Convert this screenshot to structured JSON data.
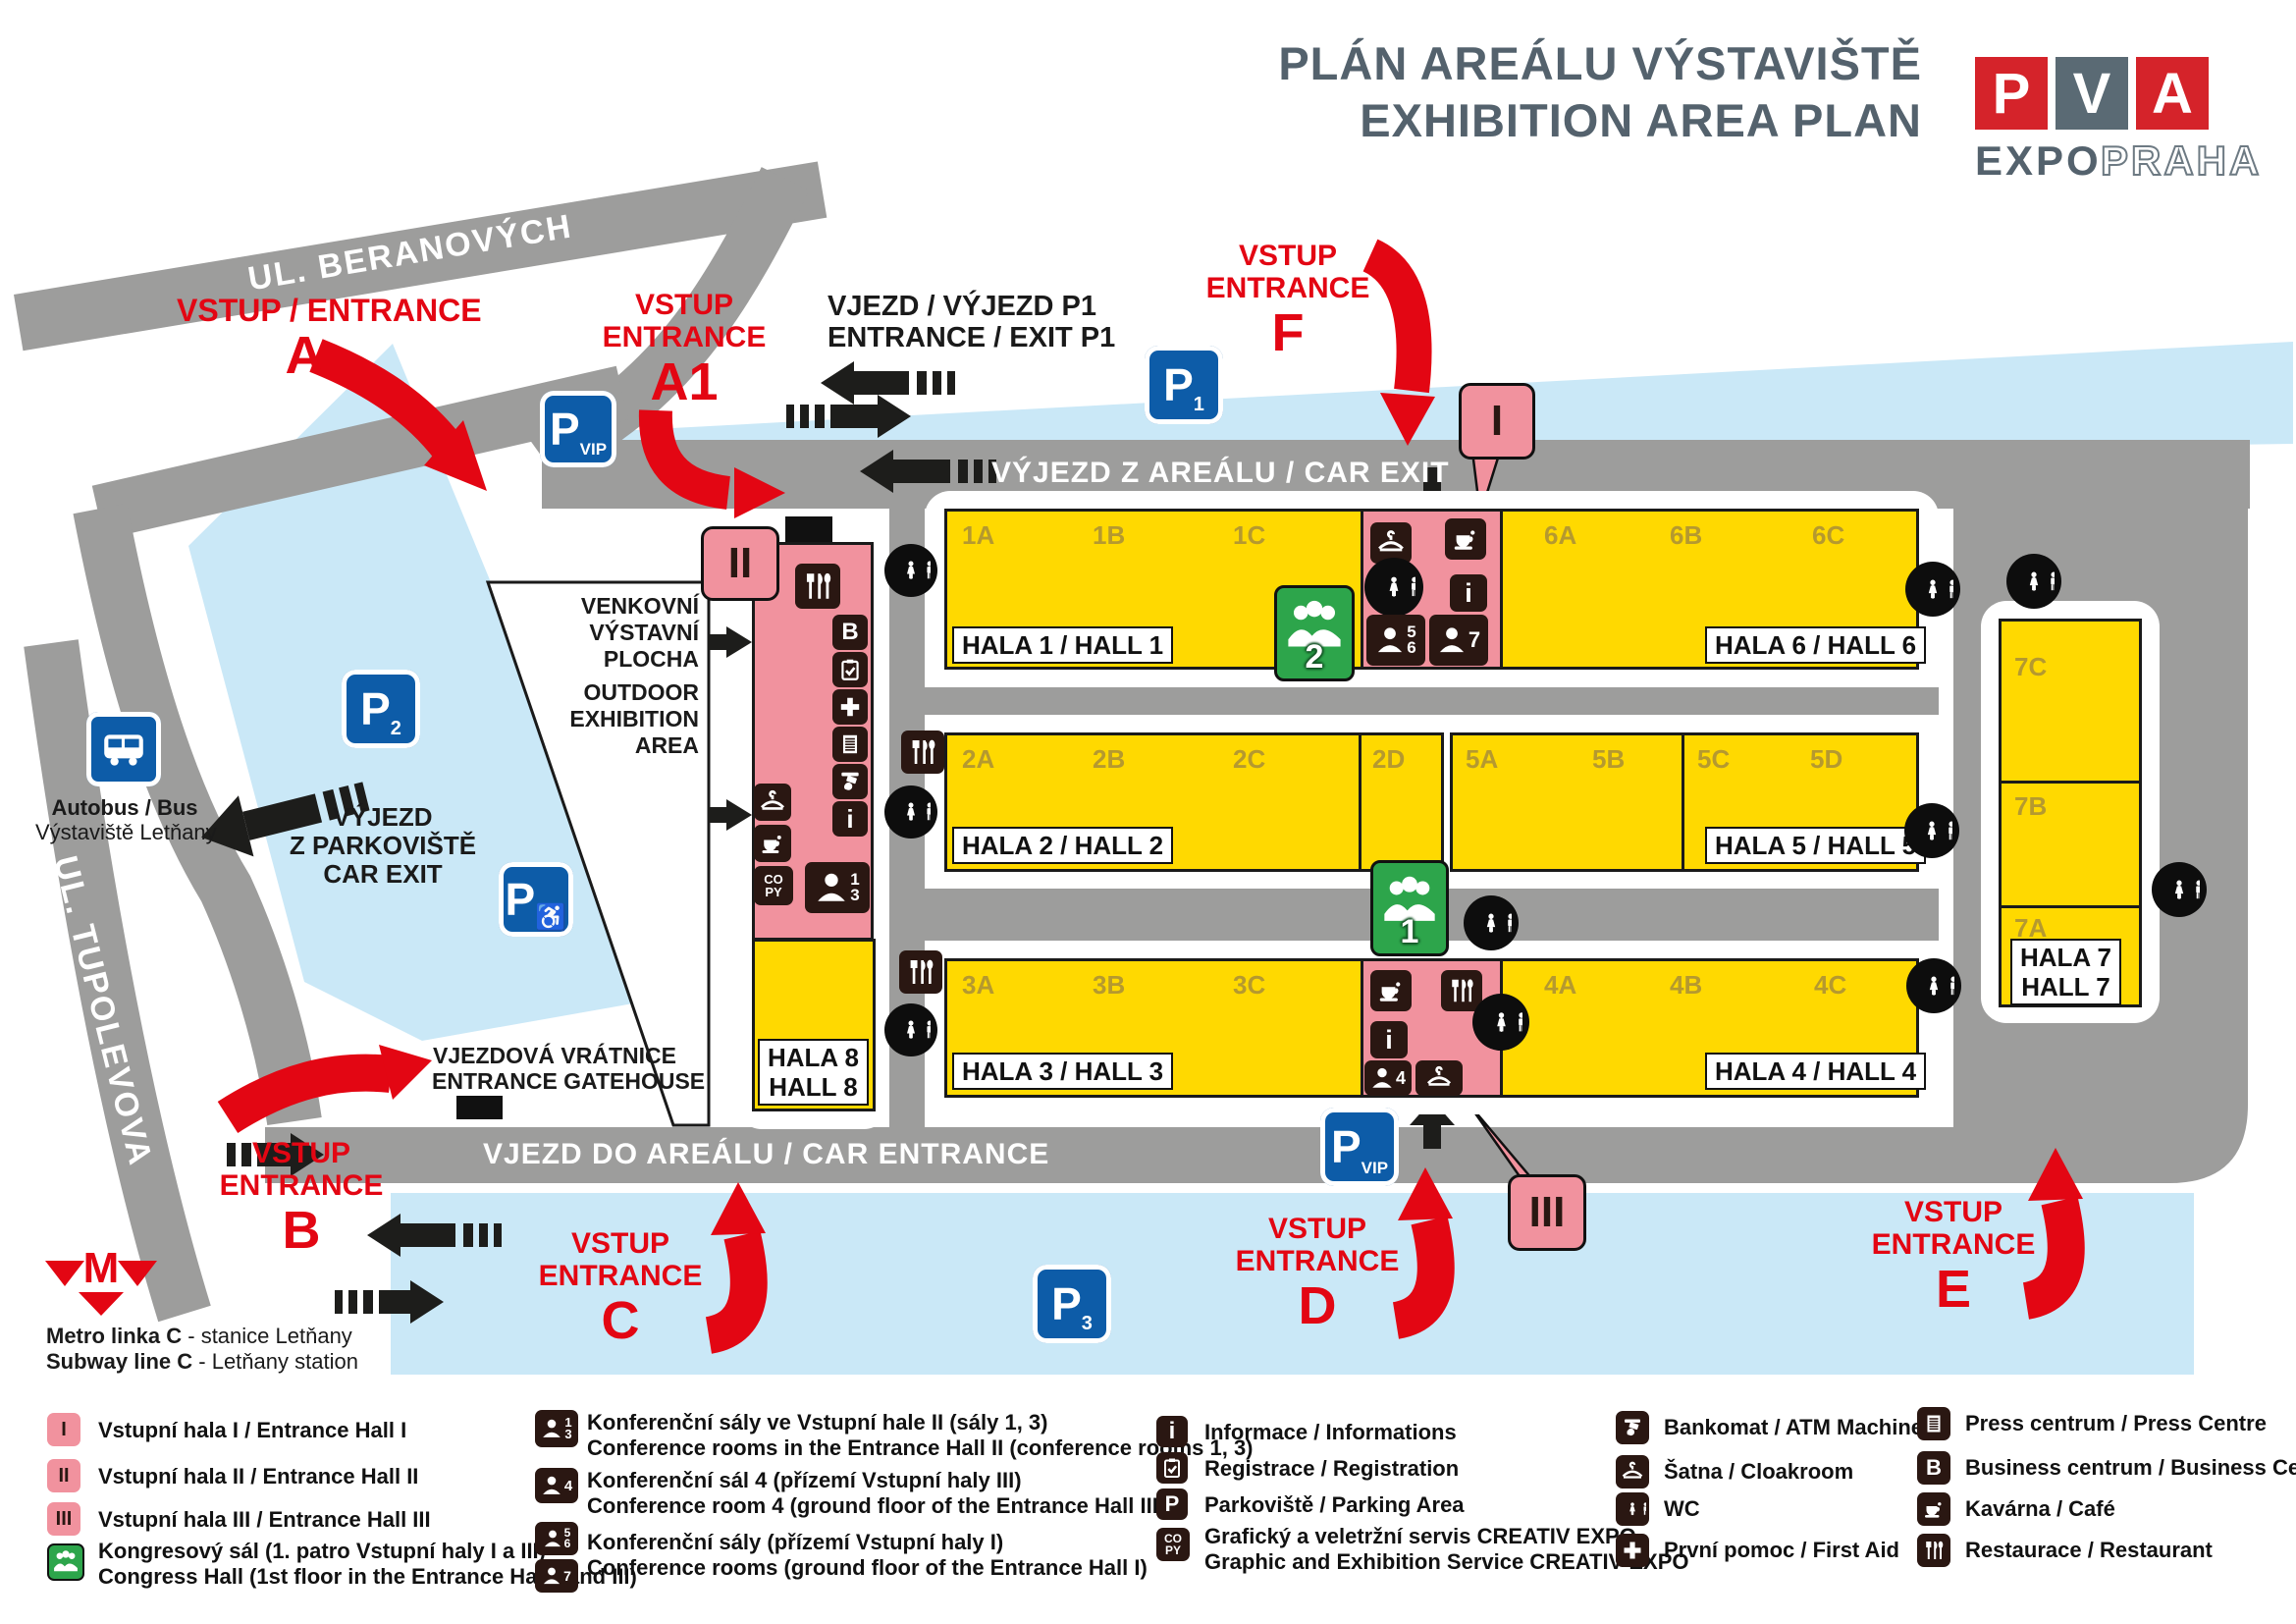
{
  "colors": {
    "red": "#e30613",
    "yellow": "#ffd900",
    "pink": "#f1929e",
    "road_gray": "#9d9d9c",
    "parking_blue": "#cae8f7",
    "sign_blue": "#0d5ca8",
    "icon_dark": "#2a1712",
    "green": "#2da54b",
    "title_gray": "#54626d",
    "section_gold": "#b5992f"
  },
  "title": {
    "line1": "PLÁN AREÁLU VÝSTAVIŠTĚ",
    "line2": "EXHIBITION AREA PLAN"
  },
  "logo": {
    "letters": [
      "P",
      "V",
      "A"
    ],
    "expo": "EXPO",
    "praha": "PRAHA"
  },
  "streets": {
    "beranovych": "UL. BERANOVÝCH",
    "tupolevova": "UL. TUPOLEVOVA"
  },
  "roads": {
    "car_exit_top": "VÝJEZD Z AREÁLU / CAR EXIT",
    "car_entrance": "VJEZD DO AREÁLU / CAR ENTRANCE",
    "gate_p1_line1": "VJEZD / VÝJEZD P1",
    "gate_p1_line2": "ENTRANCE / EXIT P1"
  },
  "parking_exit": {
    "line1": "VÝJEZD",
    "line2": "Z PARKOVIŠTĚ",
    "line3": "CAR EXIT"
  },
  "gatehouse": {
    "line1": "VJEZDOVÁ VRÁTNICE",
    "line2": "ENTRANCE GATEHOUSE"
  },
  "outdoor": {
    "cz0": "VENKOVNÍ",
    "cz1": "VÝSTAVNÍ",
    "cz2": "PLOCHA",
    "en0": "OUTDOOR",
    "en1": "EXHIBITION",
    "en2": "AREA"
  },
  "bus": {
    "line1": "Autobus / Bus",
    "line2": "Výstaviště Letňany"
  },
  "metro": {
    "m": "M",
    "line1_bold": "Metro linka C",
    "line1_rest": " - stanice Letňany",
    "line2_bold": "Subway line C",
    "line2_rest": " - Letňany station"
  },
  "entrances": {
    "a": {
      "label": "VSTUP / ENTRANCE",
      "letter": "A"
    },
    "a1": {
      "line1": "VSTUP",
      "line2": "ENTRANCE",
      "letter": "A1"
    },
    "b": {
      "line1": "VSTUP",
      "line2": "ENTRANCE",
      "letter": "B"
    },
    "c": {
      "line1": "VSTUP",
      "line2": "ENTRANCE",
      "letter": "C"
    },
    "d": {
      "line1": "VSTUP",
      "line2": "ENTRANCE",
      "letter": "D"
    },
    "e": {
      "line1": "VSTUP",
      "line2": "ENTRANCE",
      "letter": "E"
    },
    "f": {
      "line1": "VSTUP",
      "line2": "ENTRANCE",
      "letter": "F"
    }
  },
  "signs": {
    "p1": {
      "p": "P",
      "sub": "1"
    },
    "p2": {
      "p": "P",
      "sub": "2"
    },
    "p3": {
      "p": "P",
      "sub": "3"
    },
    "pvip_top": {
      "p": "P",
      "sub": "VIP"
    },
    "pvip_bottom": {
      "p": "P",
      "sub": "VIP"
    },
    "p_disabled": {
      "p": "P",
      "wheelchair": "♿"
    }
  },
  "halls": {
    "h1": {
      "name": "HALA 1 / HALL 1",
      "sections": [
        "1A",
        "1B",
        "1C"
      ]
    },
    "h2": {
      "name": "HALA 2 / HALL 2",
      "sections": [
        "2A",
        "2B",
        "2C",
        "2D"
      ]
    },
    "h3": {
      "name": "HALA 3 / HALL 3",
      "sections": [
        "3A",
        "3B",
        "3C"
      ]
    },
    "h4": {
      "name": "HALA 4 / HALL 4",
      "sections": [
        "4A",
        "4B",
        "4C"
      ]
    },
    "h5": {
      "name": "HALA 5 / HALL 5",
      "sections": [
        "5A",
        "5B",
        "5C",
        "5D"
      ]
    },
    "h6": {
      "name": "HALA 6 / HALL 6",
      "sections": [
        "6A",
        "6B",
        "6C"
      ]
    },
    "h7": {
      "name1": "HALA 7",
      "name2": "HALL 7",
      "sections": [
        "7C",
        "7B",
        "7A"
      ]
    },
    "h8": {
      "name1": "HALA 8",
      "name2": "HALL 8"
    }
  },
  "callouts": {
    "hall1": "I",
    "hall2": "II",
    "hall3": "III"
  },
  "congress_markers": {
    "hall1_marker": "2",
    "hall3_marker": "1"
  },
  "conference_markers": {
    "r13a": "1",
    "r13b": "3",
    "r4": "4",
    "r56a": "5",
    "r56b": "6",
    "r7": "7"
  },
  "icon_text": {
    "info": "i",
    "business": "B",
    "copy1": "CO",
    "copy2": "PY",
    "parking": "P",
    "wc": "WC"
  },
  "legend": {
    "entrance_halls": [
      {
        "symbol": "I",
        "text": "Vstupní hala I / Entrance Hall I"
      },
      {
        "symbol": "II",
        "text": "Vstupní hala II / Entrance Hall II"
      },
      {
        "symbol": "III",
        "text": "Vstupní hala III / Entrance Hall III"
      }
    ],
    "congress": {
      "line1": "Kongresový sál (1. patro Vstupní haly I a III)",
      "line2": "Congress Hall (1st floor in the Entrance Hall I and III)"
    },
    "conference": [
      {
        "line1": "Konferenční sály ve Vstupní hale II (sály 1, 3)",
        "line2": "Conference rooms in the Entrance Hall II (conference rooms 1, 3)"
      },
      {
        "line1": "Konferenční sál 4 (přízemí Vstupní haly III)",
        "line2": "Conference room 4 (ground floor of the Entrance Hall III)"
      },
      {
        "line1": "Konferenční sály (přízemí Vstupní haly I)",
        "line2": "Conference rooms (ground floor of the Entrance Hall I)"
      }
    ],
    "services1": [
      {
        "text": "Informace / Informations"
      },
      {
        "text": "Registrace / Registration"
      },
      {
        "text": "Parkoviště / Parking Area"
      },
      {
        "line1": "Grafický a veletržní servis CREATIV EXPO",
        "line2": "Graphic and Exhibition Service CREATIV EXPO"
      }
    ],
    "services2": [
      {
        "text": "Bankomat / ATM Machine"
      },
      {
        "text": "Šatna / Cloakroom"
      },
      {
        "text": "WC"
      },
      {
        "text": "První pomoc / First Aid"
      }
    ],
    "services3": [
      {
        "text": "Press centrum / Press Centre"
      },
      {
        "text": "Business centrum / Business Centre"
      },
      {
        "text": "Kavárna / Café"
      },
      {
        "text": "Restaurace / Restaurant"
      }
    ]
  }
}
